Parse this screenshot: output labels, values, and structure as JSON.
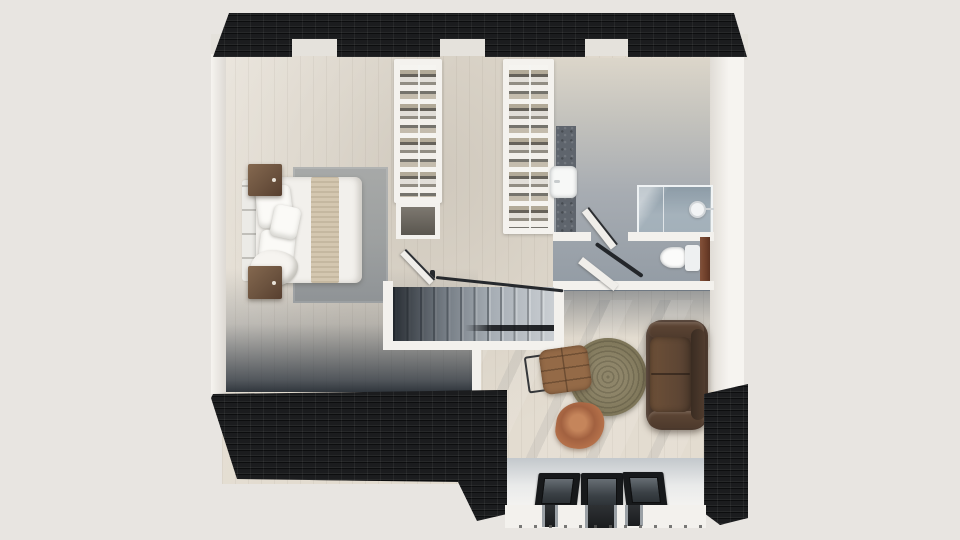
{
  "scene": {
    "kind": "3d-rendered-floor-plan",
    "view": "top-down-isometric",
    "floor": "upper-level-attic",
    "rooms": [
      {
        "name": "bedroom",
        "furniture": [
          "double-bed",
          "headboard",
          "pillows",
          "throw-runner",
          "area-rug",
          "nightstand-left",
          "nightstand-right"
        ]
      },
      {
        "name": "hallway-landing",
        "furniture": [
          "walk-in-closet-1",
          "walk-in-closet-2",
          "closet-alcove",
          "staircase",
          "stair-railing",
          "bedroom-door"
        ]
      },
      {
        "name": "bathroom",
        "furniture": [
          "vanity-counter",
          "washbasin",
          "glass-shower-enclosure",
          "round-mirror",
          "toilet",
          "wood-panel",
          "bathroom-door"
        ]
      },
      {
        "name": "living-area",
        "furniture": [
          "leather-sofa",
          "round-jute-rug",
          "leather-armchair",
          "tree-stump-side-table"
        ]
      },
      {
        "name": "dormer",
        "furniture": [
          "roof-window-1",
          "roof-window-2",
          "roof-window-3"
        ]
      }
    ],
    "structure": [
      "top-roof-strip-with-three-dormer-notches",
      "bottom-left-roof-slope",
      "bottom-right-roof-pillar",
      "white-perimeter-walls",
      "stairwell-opening"
    ]
  },
  "colors": {
    "background": "#e8e5e1",
    "roof": "#1b1c1e",
    "wall": "#f3f1ed",
    "wall_band": "#e5e2dc",
    "floor_wood": "#e3dcd0",
    "floor_bath_gray": "#9aa3ab",
    "bedroom_rug": "#a3a5a4",
    "bed_linen": "#f2f0ec",
    "bed_throw": "#d4c7b0",
    "nightstand_wood": "#6c533f",
    "closet_clothes_base": "#9fa8ae",
    "stairs": "#aab1b8",
    "vanity_counter": "#5f656d",
    "shower_glass": "#a8bbc7",
    "wc_wood_panel": "#6e3f2a",
    "sofa_leather": "#4a372b",
    "round_rug": "#7c7458",
    "armchair_leather": "#946a47",
    "stump_table": "#b5714a",
    "roof_window_frame": "#17191b"
  }
}
